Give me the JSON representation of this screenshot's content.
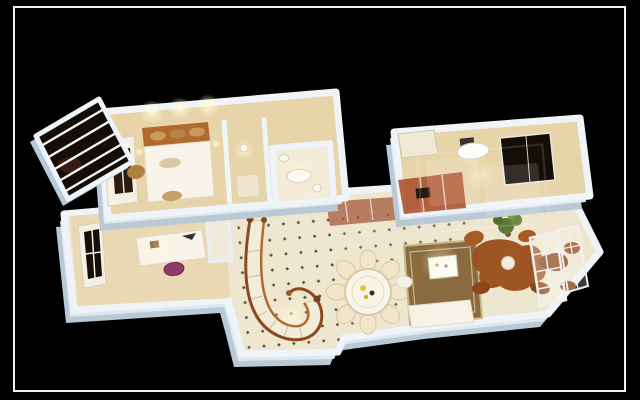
{
  "scene": {
    "description": "Photorealistic 3D bird's-eye render of a duplex apartment floor-plan model on a black background inside a thin white photo frame; upper bedroom suite and kitchen blocks, lower level with study, spiral staircase, round dining table with radiating chairs, rug with sofa and TV, rust-brown seating group, glazed french doors, plant and balcony with slatted roof; a faint semi-transparent watermark overlays the middle-right area",
    "palette": {
      "background": "#000000",
      "frame": "#f0f0f0",
      "wall_top": "#eef4f8",
      "wall_side": "#b9c9d6",
      "wall_mid": "#dde8ef",
      "floor_warm": "#e7d4a9",
      "floor_tile": "#efe6cf",
      "floor_light": "#f4ecd8",
      "glow": "#fff7d8",
      "wood": "#8a4a1e",
      "wood_light": "#b06a2e",
      "rug": "#8a6b40",
      "furniture_white": "#f8f4ea",
      "sofa_brown": "#9a4f1d",
      "chair_purple": "#93386e",
      "plant_green": "#5d7a33",
      "window_dark": "#140e06",
      "counter_red": "#a84a28",
      "stair_tread": "#f4ecda"
    },
    "rooms": [
      {
        "name": "balcony"
      },
      {
        "name": "master-bedroom"
      },
      {
        "name": "dressing-corridor"
      },
      {
        "name": "bathroom"
      },
      {
        "name": "kitchen"
      },
      {
        "name": "study"
      },
      {
        "name": "stair-hall"
      },
      {
        "name": "dining-room"
      },
      {
        "name": "living-room"
      },
      {
        "name": "sun-room"
      }
    ],
    "watermark_present": true
  }
}
